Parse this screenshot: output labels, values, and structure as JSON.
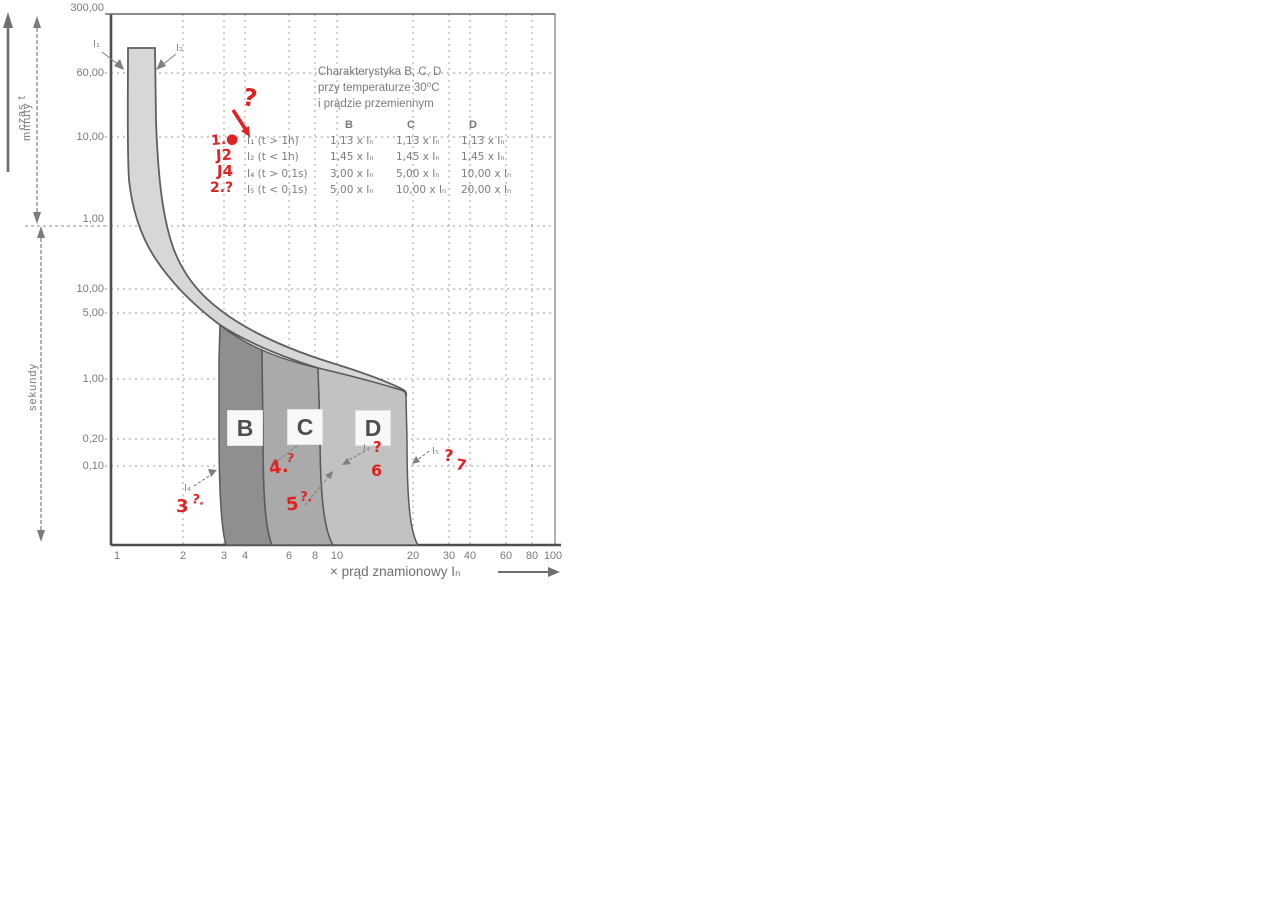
{
  "figure": {
    "description": "Scanned trip-characteristic chart of miniature circuit breakers"
  },
  "colors": {
    "scan_text": "#7a7a7a",
    "line": "#5f5f5f",
    "grid": "#9a9a9a",
    "thermal_band_fill": "#d7d7d7",
    "band_b_fill": "#8f8f8f",
    "band_c_fill": "#aaaaaa",
    "band_d_fill": "#c2c2c2",
    "annotation_red": "#e02222"
  },
  "axis": {
    "x_title": "× prąd znamionowy Iₙ",
    "x_ticks": [
      "1",
      "2",
      "3",
      "4",
      "6",
      "8",
      "10",
      "20",
      "30",
      "40",
      "60",
      "80",
      "100"
    ],
    "y_minutes_ticks": [
      "300,00",
      "60,00",
      "10,00",
      "1,00"
    ],
    "y_seconds_ticks": [
      "10,00",
      "5,00",
      "1,00",
      "0,20",
      "0,10"
    ],
    "time_label": "czas  t",
    "minutes_label": "minuty",
    "seconds_label": "sekundy"
  },
  "table": {
    "title_lines": [
      "Charakterystyka  B, C, D",
      "przy temperaturze 30⁰C",
      "i prądzie przemiennym"
    ],
    "headers": [
      "B",
      "C",
      "D"
    ],
    "rows": [
      {
        "label": "I₁ (t > 1h)",
        "values": [
          "1,13 x Iₙ",
          "1,13 x Iₙ",
          "1,13 x Iₙ"
        ]
      },
      {
        "label": "I₂ (t < 1h)",
        "values": [
          "1,45 x Iₙ",
          "1,45 x Iₙ",
          "1,45 x Iₙ"
        ]
      },
      {
        "label": "I₄ (t > 0,1s)",
        "values": [
          "3,00 x Iₙ",
          "5,00 x Iₙ",
          "10,00 x Iₙ"
        ]
      },
      {
        "label": "I₅ (t < 0,1s)",
        "values": [
          "5,00 x Iₙ",
          "10,00 x Iₙ",
          "20,00 x Iₙ"
        ]
      }
    ]
  },
  "bands": [
    "B",
    "C",
    "D"
  ],
  "arrow_labels": {
    "i1": "I₁",
    "i2": "I₂",
    "i4_left": "I₄",
    "i4_mid": "I₄",
    "i5_right": "I₅"
  },
  "annotations": {
    "q_table": "?",
    "n1": "1.●",
    "j2": "J2",
    "j4": "J4",
    "n2": "2.?",
    "n3": "3",
    "q3": "?.",
    "n4": "4.",
    "q4": "?",
    "n5": "5",
    "q5": "?.",
    "q6": "?",
    "n6": "6",
    "q7": "?",
    "n7": "7"
  },
  "chart_data": {
    "type": "area",
    "title": "Charakterystyka B, C, D przy temperaturze 30⁰C i prądzie przemiennym",
    "xlabel": "× prąd znamionowy Iₙ",
    "x_scale": "log",
    "x_range": [
      1,
      100
    ],
    "x_ticks": [
      1,
      2,
      3,
      4,
      6,
      8,
      10,
      20,
      30,
      40,
      60,
      80,
      100
    ],
    "grid": true,
    "y_axis": {
      "label": "czas t",
      "sections": [
        {
          "label": "minuty",
          "unit": "min",
          "ticks": [
            300,
            60,
            10,
            1
          ]
        },
        {
          "label": "sekundy",
          "unit": "s",
          "ticks": [
            10,
            5,
            1,
            0.2,
            0.1
          ]
        }
      ]
    },
    "series": [
      {
        "name": "pasmo wyzwalania termicznego",
        "type": "band",
        "current_multiples": [
          1.13,
          1.45
        ]
      },
      {
        "name": "B",
        "type": "band",
        "current_multiples": [
          3,
          5
        ]
      },
      {
        "name": "C",
        "type": "band",
        "current_multiples": [
          5,
          10
        ]
      },
      {
        "name": "D",
        "type": "band",
        "current_multiples": [
          10,
          20
        ]
      }
    ],
    "thresholds": {
      "I1": {
        "condition": "t > 1h",
        "B": 1.13,
        "C": 1.13,
        "D": 1.13
      },
      "I2": {
        "condition": "t < 1h",
        "B": 1.45,
        "C": 1.45,
        "D": 1.45
      },
      "I4": {
        "condition": "t > 0,1s",
        "B": 3.0,
        "C": 5.0,
        "D": 10.0
      },
      "I5": {
        "condition": "t < 0,1s",
        "B": 5.0,
        "C": 10.0,
        "D": 20.0
      }
    }
  }
}
